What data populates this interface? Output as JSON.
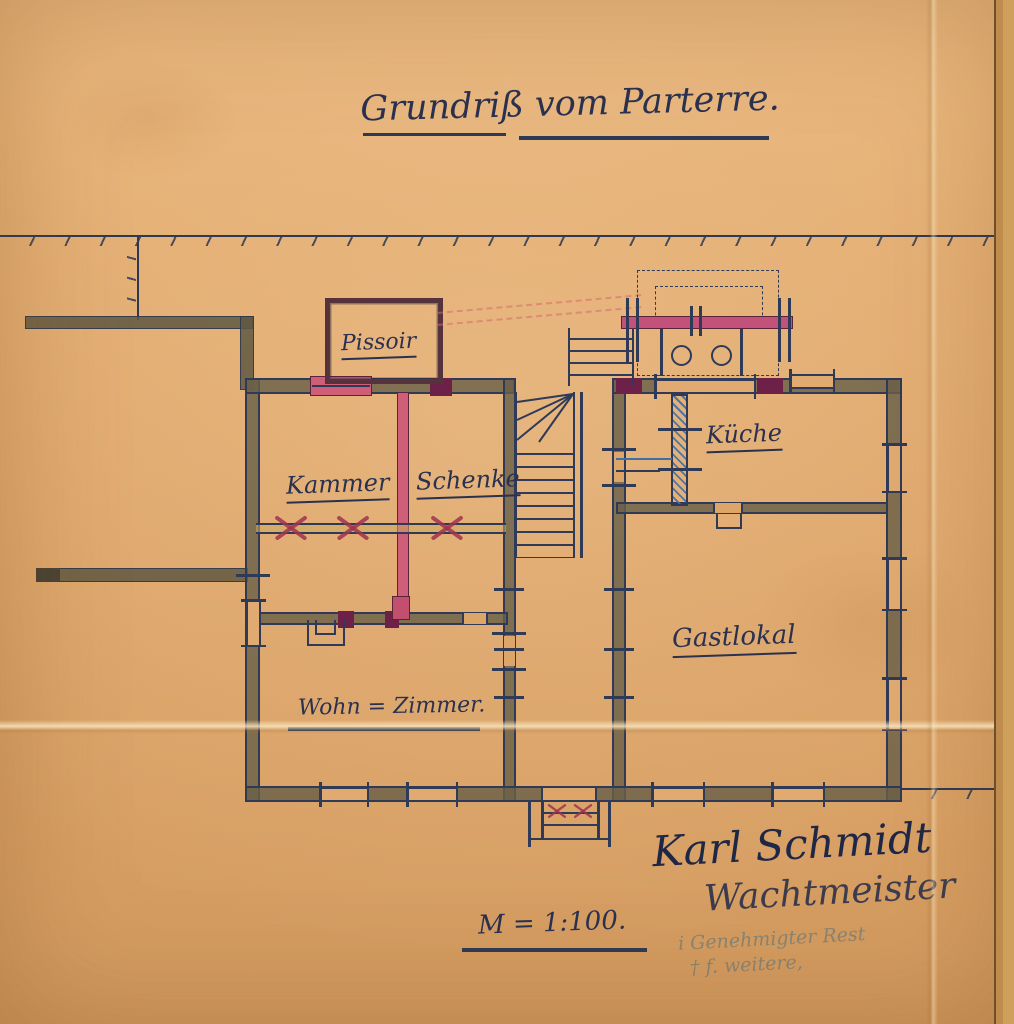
{
  "document": {
    "title": "Grundriß vom Parterre.",
    "scale_label": "M = 1:100.",
    "signature": {
      "name": "Karl Schmidt",
      "title": "Wachtmeister"
    },
    "pencil_note": {
      "line1": "i Genehmigter Rest",
      "line2": "† f. weitere,"
    }
  },
  "rooms": {
    "pissoir": {
      "label": "Pissoir"
    },
    "kammer": {
      "label": "Kammer"
    },
    "schenke": {
      "label": "Schenke"
    },
    "kueche": {
      "label": "Küche"
    },
    "gastlokal": {
      "label": "Gastlokal"
    },
    "wohnzimmer": {
      "label": "Wohn = Zimmer."
    }
  },
  "colors": {
    "paper": "#dfa96e",
    "ink": "#2c3a56",
    "wall_fill": "#6a6048",
    "accent_pink": "#cf5e79",
    "accent_crimson": "#9e3450",
    "accent_maroon": "#6e2148",
    "accent_blue": "#3e6fa6",
    "pencil": "#8a8472"
  }
}
